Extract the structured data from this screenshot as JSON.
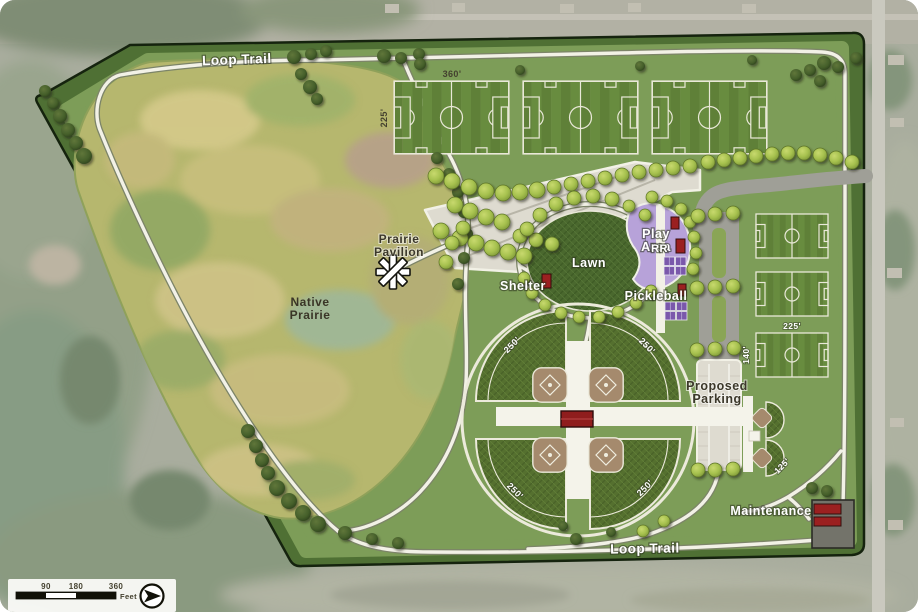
{
  "map": {
    "labels": {
      "loop_trail_top": "Loop Trail",
      "loop_trail_bottom": "Loop Trail",
      "native_prairie_1": "Native",
      "native_prairie_2": "Prairie",
      "prairie_pavilion_1": "Prairie",
      "prairie_pavilion_2": "Pavilion",
      "shelter": "Shelter",
      "lawn": "Lawn",
      "play_area_1": "Play",
      "play_area_2": "Area",
      "rr": "RR",
      "pickleball": "Pickleball",
      "proposed_parking_1": "Proposed",
      "proposed_parking_2": "Parking",
      "maintenance": "Maintenance",
      "dim_soccer_length": "360'",
      "dim_soccer_width": "225'",
      "dim_small_soccer_length": "225'",
      "dim_small_soccer_width": "140'",
      "dim_ballfield_tl": "250'",
      "dim_ballfield_tr": "250'",
      "dim_ballfield_bl": "250'",
      "dim_ballfield_br": "250'",
      "dim_small_ballfield": "125'"
    },
    "scale_bar": {
      "ticks": [
        "90",
        "180",
        "360"
      ],
      "unit": "Feet"
    },
    "compass": "north-arrow",
    "colors": {
      "park_green": "#7d9d58",
      "border_green": "#4f7034",
      "prairie": "#b6b76e",
      "trail": "#f2f1e6",
      "soccer_green": "#5f8038",
      "soccer_stripe": "#688c3f",
      "lawn_green": "#4a682e",
      "outfield_green": "#55702f",
      "infield_brown": "#a58a6d",
      "play_area_purple": "#b7a2d9",
      "pickleball_purple": "#7a58ab",
      "building_red": "#9b2020",
      "parking_gray": "#9f9f97",
      "proposed_parking_light": "#dedbd0",
      "aerial_ground": "#a9ad9e"
    },
    "decor": {
      "trees_light": [
        [
          436,
          176,
          8
        ],
        [
          452,
          181,
          8
        ],
        [
          469,
          187,
          8
        ],
        [
          486,
          191,
          8
        ],
        [
          503,
          193,
          8
        ],
        [
          520,
          192,
          8
        ],
        [
          537,
          190,
          8
        ],
        [
          554,
          187,
          7
        ],
        [
          571,
          184,
          7
        ],
        [
          588,
          181,
          7
        ],
        [
          605,
          178,
          7
        ],
        [
          622,
          175,
          7
        ],
        [
          639,
          172,
          7
        ],
        [
          656,
          170,
          7
        ],
        [
          673,
          168,
          7
        ],
        [
          690,
          166,
          7
        ],
        [
          455,
          205,
          8
        ],
        [
          470,
          211,
          8
        ],
        [
          486,
          217,
          8
        ],
        [
          502,
          222,
          8
        ],
        [
          441,
          231,
          8
        ],
        [
          460,
          238,
          8
        ],
        [
          476,
          243,
          8
        ],
        [
          492,
          248,
          8
        ],
        [
          508,
          252,
          8
        ],
        [
          524,
          256,
          8
        ],
        [
          446,
          262,
          7
        ],
        [
          520,
          236,
          7
        ],
        [
          536,
          240,
          7
        ],
        [
          552,
          244,
          7
        ],
        [
          708,
          162,
          7
        ],
        [
          724,
          160,
          7
        ],
        [
          740,
          158,
          7
        ],
        [
          756,
          156,
          7
        ],
        [
          772,
          154,
          7
        ],
        [
          788,
          153,
          7
        ],
        [
          804,
          153,
          7
        ],
        [
          820,
          155,
          7
        ],
        [
          836,
          158,
          7
        ],
        [
          852,
          162,
          7
        ],
        [
          527,
          229,
          7
        ],
        [
          540,
          215,
          7
        ],
        [
          556,
          204,
          7
        ],
        [
          574,
          198,
          7
        ],
        [
          593,
          196,
          7
        ],
        [
          612,
          199,
          7
        ],
        [
          629,
          206,
          6
        ],
        [
          645,
          215,
          6
        ],
        [
          524,
          278,
          6
        ],
        [
          532,
          293,
          6
        ],
        [
          545,
          305,
          6
        ],
        [
          561,
          313,
          6
        ],
        [
          579,
          317,
          6
        ],
        [
          599,
          317,
          6
        ],
        [
          618,
          312,
          6
        ],
        [
          636,
          303,
          6
        ],
        [
          651,
          291,
          6
        ],
        [
          652,
          197,
          6
        ],
        [
          667,
          201,
          6
        ],
        [
          681,
          209,
          6
        ],
        [
          690,
          222,
          6
        ],
        [
          694,
          237,
          6
        ],
        [
          696,
          253,
          6
        ],
        [
          693,
          269,
          6
        ],
        [
          698,
          216,
          7
        ],
        [
          715,
          214,
          7
        ],
        [
          733,
          213,
          7
        ],
        [
          697,
          288,
          7
        ],
        [
          715,
          287,
          7
        ],
        [
          733,
          286,
          7
        ],
        [
          697,
          350,
          7
        ],
        [
          715,
          349,
          7
        ],
        [
          734,
          348,
          7
        ],
        [
          698,
          470,
          7
        ],
        [
          715,
          470,
          7
        ],
        [
          733,
          469,
          7
        ],
        [
          664,
          521,
          6
        ],
        [
          643,
          531,
          6
        ],
        [
          452,
          243,
          7
        ],
        [
          463,
          228,
          7
        ]
      ],
      "trees_dark": [
        [
          45,
          91,
          6
        ],
        [
          53,
          103,
          6
        ],
        [
          60,
          116,
          7
        ],
        [
          68,
          130,
          7
        ],
        [
          76,
          143,
          7
        ],
        [
          84,
          156,
          8
        ],
        [
          248,
          431,
          7
        ],
        [
          256,
          446,
          7
        ],
        [
          262,
          460,
          7
        ],
        [
          268,
          473,
          7
        ],
        [
          277,
          488,
          8
        ],
        [
          289,
          501,
          8
        ],
        [
          303,
          513,
          8
        ],
        [
          318,
          524,
          8
        ],
        [
          345,
          533,
          7
        ],
        [
          372,
          539,
          6
        ],
        [
          398,
          543,
          6
        ],
        [
          294,
          57,
          7
        ],
        [
          311,
          54,
          6
        ],
        [
          326,
          51,
          6
        ],
        [
          384,
          56,
          7
        ],
        [
          401,
          58,
          6
        ],
        [
          419,
          54,
          6
        ],
        [
          301,
          74,
          6
        ],
        [
          310,
          87,
          7
        ],
        [
          317,
          99,
          6
        ],
        [
          437,
          158,
          6
        ],
        [
          449,
          174,
          6
        ],
        [
          458,
          192,
          6
        ],
        [
          464,
          212,
          6
        ],
        [
          467,
          234,
          6
        ],
        [
          464,
          258,
          6
        ],
        [
          458,
          284,
          6
        ],
        [
          420,
          64,
          6
        ],
        [
          520,
          70,
          5
        ],
        [
          640,
          66,
          5
        ],
        [
          752,
          60,
          5
        ],
        [
          824,
          63,
          7
        ],
        [
          838,
          67,
          6
        ],
        [
          810,
          70,
          6
        ],
        [
          796,
          75,
          6
        ],
        [
          820,
          81,
          6
        ],
        [
          856,
          58,
          6
        ],
        [
          812,
          488,
          6
        ],
        [
          827,
          491,
          6
        ],
        [
          563,
          526,
          5
        ],
        [
          576,
          539,
          6
        ],
        [
          611,
          532,
          5
        ]
      ]
    }
  }
}
